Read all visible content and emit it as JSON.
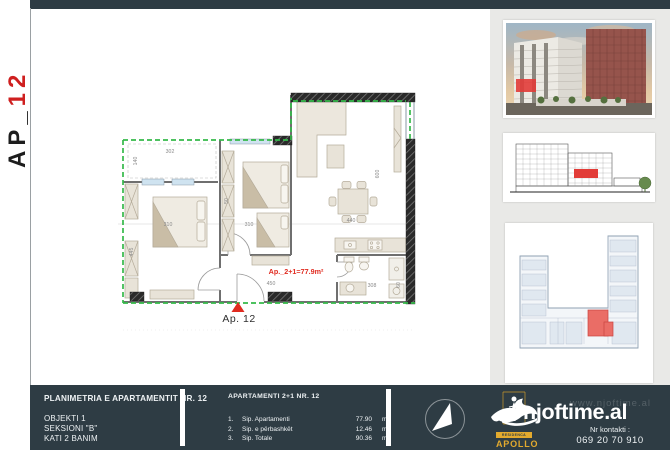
{
  "strip": {
    "prefix": "AP_",
    "number": "12"
  },
  "plan": {
    "area_text": "Ap._2+1=77.9m²",
    "unit_label": "Ap. 12",
    "dims": {
      "balcony_w": "302",
      "balcony_h": "140",
      "bed1_w": "310",
      "bed1_h": "445",
      "wardrobe": "50",
      "bed2_w": "310",
      "dining": "440",
      "living": "600",
      "hall": "450",
      "bath": "308",
      "kitchen": "60"
    }
  },
  "footer": {
    "left": {
      "title": "PLANIMETRIA E APARTAMENTIT NR. 12",
      "line1": "OBJEKTI 1",
      "line2": "SEKSIONI \"B\"",
      "line3": "KATI 2 BANIM"
    },
    "middle": {
      "title": "APARTAMENTI 2+1 NR. 12",
      "rows": [
        {
          "no": "1.",
          "label": "Sip. Apartamenti",
          "value": "77.90",
          "unit": "m²"
        },
        {
          "no": "2.",
          "label": "Sip. e përbashkët",
          "value": "12.46",
          "unit": "m²"
        },
        {
          "no": "3.",
          "label": "Sip. Totale",
          "value": "90.36",
          "unit": "m²"
        }
      ]
    },
    "brand": {
      "name": "njoftime.al",
      "watermark": "www.njoftime.al",
      "contact_label": "Nr kontakti :",
      "phone": "069 20 70 910",
      "residence_label": "RESIDENCA",
      "residence_name": "APOLLO"
    }
  },
  "colors": {
    "bar": "#2e3c44",
    "green": "#35b94a",
    "red": "#e02b20",
    "yellow": "#e3aa2e",
    "sidebar_bg": "#e9e9e7"
  }
}
